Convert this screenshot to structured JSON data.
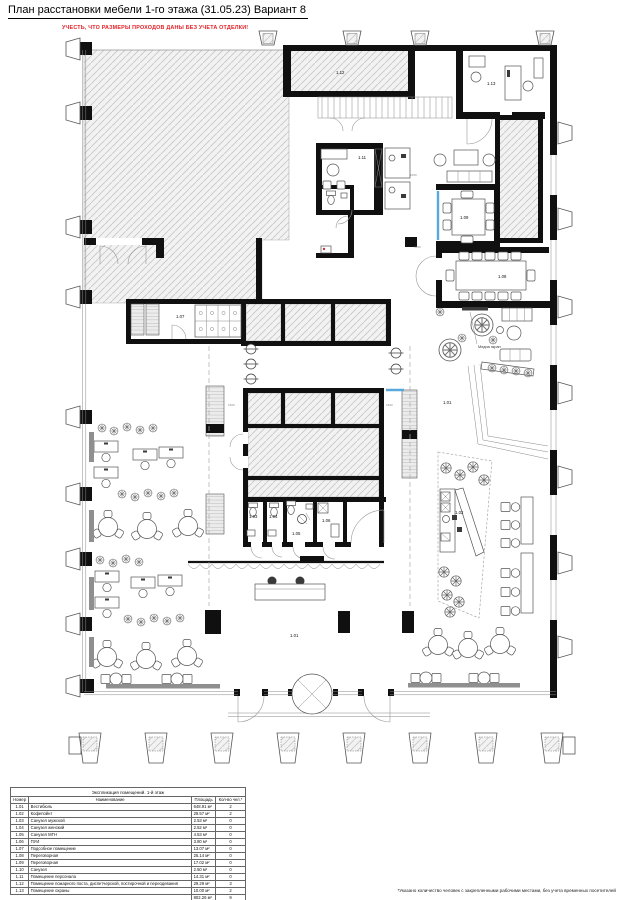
{
  "header": {
    "title": "План расстановки мебели 1-го этажа (31.05.23) Вариант 8",
    "warning": "УЧЕСТЬ, ЧТО РАЗМЕРЫ ПРОХОДОВ ДАНЫ БЕЗ УЧЕТА ОТДЕЛКИ!"
  },
  "plan": {
    "colors": {
      "glazing": "#58a8dc",
      "warning_red": "#e31e24",
      "hatch_gray": "#c6c6c6"
    },
    "labels": [
      {
        "text": "1.12"
      },
      {
        "text": "1.13"
      },
      {
        "text": "1.11"
      },
      {
        "text": "1.09"
      },
      {
        "text": "1.08"
      },
      {
        "text": "1.07"
      },
      {
        "text": "1.01"
      },
      {
        "text": "1.02"
      },
      {
        "text": "1.03"
      },
      {
        "text": "1.04"
      },
      {
        "text": "1.05"
      },
      {
        "text": "1.06"
      },
      {
        "text": "1.01"
      }
    ],
    "annotations": [
      {
        "text": "Медиа экран"
      }
    ],
    "dimensions": [
      {
        "text": "1050"
      },
      {
        "text": "1050"
      },
      {
        "text": "1500"
      },
      {
        "text": "1500"
      }
    ]
  },
  "schedule": {
    "title": "Экспликация помещений. 1-й этаж",
    "columns": [
      "Номер",
      "Наименование",
      "Площадь",
      "Кол-во чел.*"
    ],
    "rows": [
      [
        "1.01",
        "Вестибюль",
        "648.91 м²",
        "2"
      ],
      [
        "1.02",
        "Кофепойнт",
        "29.57 м²",
        "2"
      ],
      [
        "1.03",
        "Санузел мужской",
        "2.53 м²",
        "0"
      ],
      [
        "1.04",
        "Санузел женский",
        "2.52 м²",
        "0"
      ],
      [
        "1.05",
        "Санузел МГН",
        "4.53 м²",
        "0"
      ],
      [
        "1.06",
        "ПУИ",
        "3.80 м²",
        "0"
      ],
      [
        "1.07",
        "Подсобное помещение",
        "13.07 м²",
        "0"
      ],
      [
        "1.08",
        "Переговорная",
        "25.14 м²",
        "0"
      ],
      [
        "1.09",
        "Переговорная",
        "17.02 м²",
        "0"
      ],
      [
        "1.10",
        "Санузел",
        "2.50 м²",
        "0"
      ],
      [
        "1.11",
        "Помещение персонала",
        "14.31 м²",
        "0"
      ],
      [
        "1.12",
        "Помещение пожарного поста, диспетчерской, постирочной и переодевания",
        "29.29 м²",
        "3"
      ],
      [
        "1.13",
        "Помещение охраны",
        "10.00 м²",
        "2"
      ]
    ],
    "total_area": "802.26 м²",
    "total_people": "9"
  },
  "footnote": "*Указано количество человек с закрепленными рабочими местами, без учета временных посетителей"
}
